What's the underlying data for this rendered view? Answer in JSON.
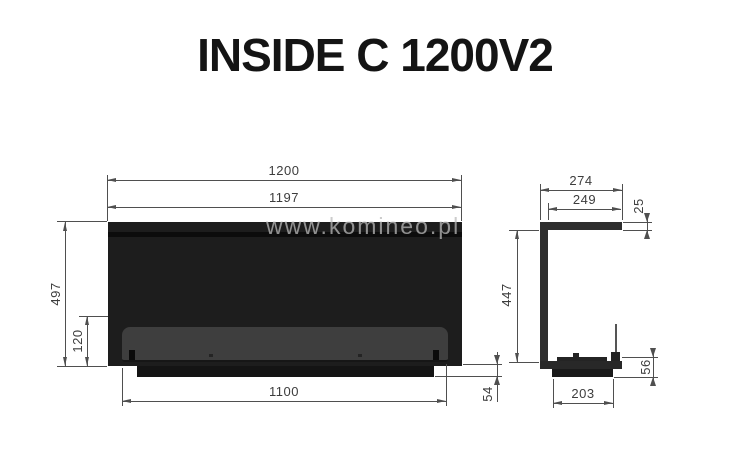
{
  "title": "INSIDE C 1200V2",
  "watermark": "www.komineo.pl",
  "front_view": {
    "width_outer": "1200",
    "width_inner": "1197",
    "height_total": "497",
    "glass_strip_height": "120",
    "opening_width": "1100",
    "base_height": "54"
  },
  "side_view": {
    "depth_outer": "274",
    "depth_top_inner": "249",
    "top_plate_thickness": "25",
    "inner_height": "447",
    "base_depth": "203",
    "base_height": "56"
  },
  "colors": {
    "body_fill": "#1d1d1d",
    "glass_fill": "#3e3e3e",
    "line": "#4f4f4f",
    "label_text": "#3d3d3d",
    "watermark_text": "#bbbbbb"
  }
}
